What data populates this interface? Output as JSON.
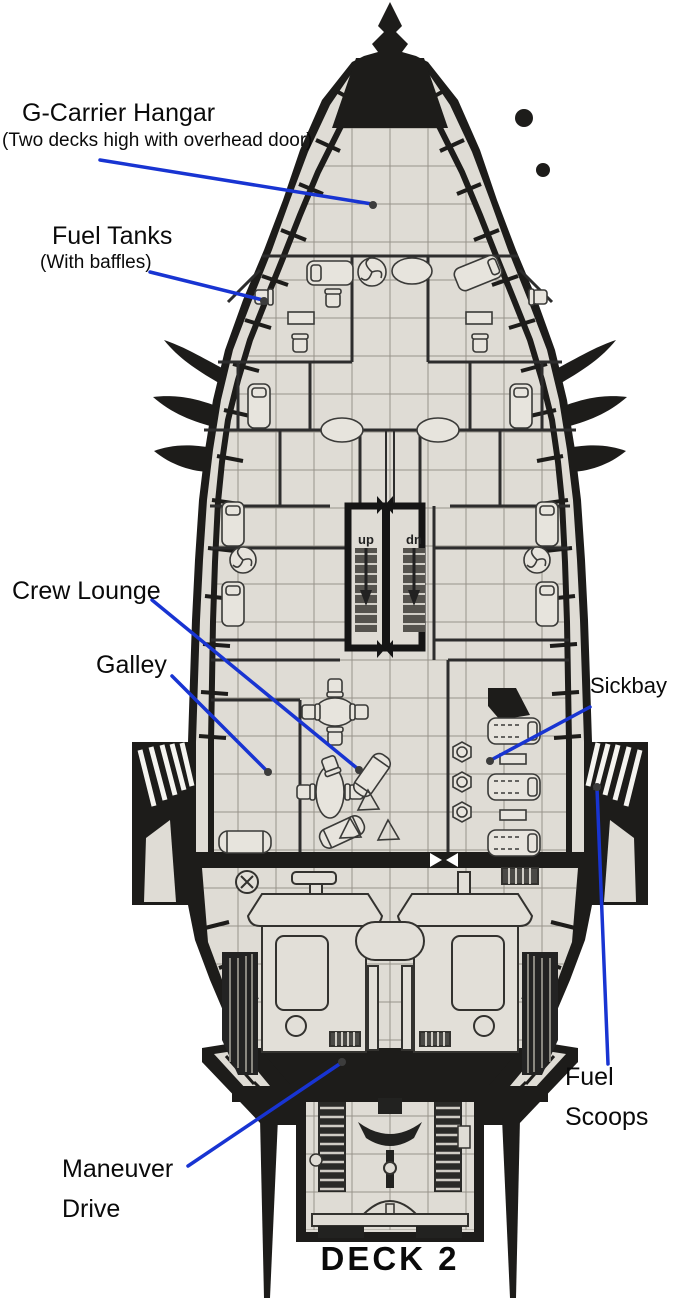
{
  "figure": {
    "deck_title": "DECK 2",
    "type": "starship deck plan"
  },
  "annotations": {
    "hangar_title": "G-Carrier Hangar",
    "hangar_sub": "(Two decks high with overhead door)",
    "fuel_tanks_title": "Fuel Tanks",
    "fuel_tanks_sub": "(With baffles)",
    "crew_lounge": "Crew Lounge",
    "galley": "Galley",
    "sickbay": "Sickbay",
    "fuel_scoops_line1": "Fuel",
    "fuel_scoops_line2": "Scoops",
    "maneuver_line1": "Maneuver",
    "maneuver_line2": "Drive"
  },
  "stairs": {
    "up": "up",
    "down": "dn"
  },
  "colors": {
    "leader_blue": "#1834d2",
    "hull_black": "#1d1c1a",
    "floor_gray": "#dfdcd5"
  }
}
